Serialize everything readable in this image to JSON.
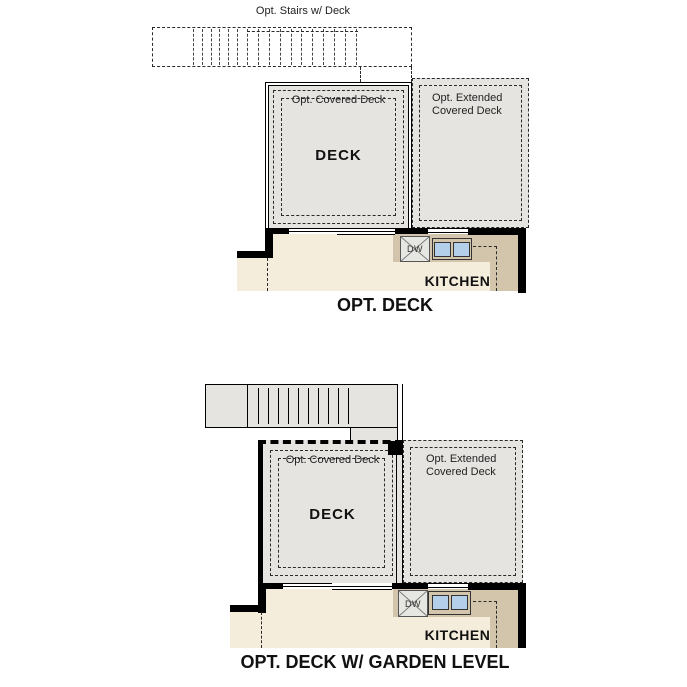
{
  "colors": {
    "deck_fill": "#e5e4e1",
    "floor": "#f4eddc",
    "counter": "#d2c5ab",
    "sink": "#b4cfe9",
    "wall": "#000000",
    "line": "#2a2a2a"
  },
  "plan_top": {
    "caption": "OPT. DECK",
    "stairs_label": "Opt. Stairs w/ Deck",
    "covered_deck_label": "Opt. Covered Deck",
    "extended_deck_label_line1": "Opt. Extended",
    "extended_deck_label_line2": "Covered Deck",
    "deck_label": "DECK",
    "dishwasher_label": "DW",
    "kitchen_label": "KITCHEN"
  },
  "plan_bottom": {
    "caption": "OPT. DECK W/ GARDEN LEVEL",
    "covered_deck_label": "Opt. Covered Deck",
    "extended_deck_label_line1": "Opt. Extended",
    "extended_deck_label_line2": "Covered Deck",
    "deck_label": "DECK",
    "dishwasher_label": "DW",
    "kitchen_label": "KITCHEN"
  }
}
